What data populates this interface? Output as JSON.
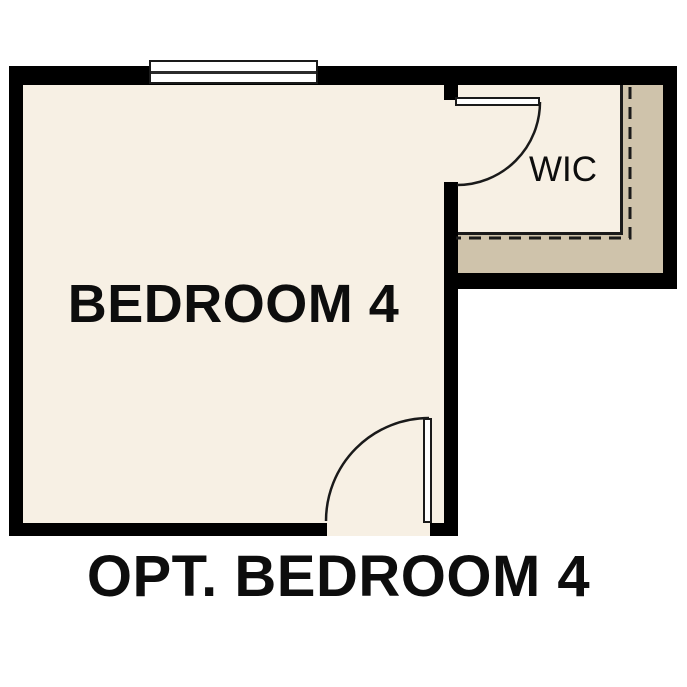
{
  "plan": {
    "caption": "OPT. BEDROOM 4",
    "rooms": {
      "bedroom": {
        "label": "BEDROOM 4"
      },
      "wic": {
        "label": "WIC"
      }
    },
    "symbols": {
      "window_count": 1,
      "door_count": 2,
      "closet_shelf_line": "dashed"
    },
    "colors": {
      "background": "#ffffff",
      "floor": "#f7f0e4",
      "closet_strip": "#cfc3ab",
      "wall": "#000000",
      "line": "#1a1a1a"
    }
  }
}
